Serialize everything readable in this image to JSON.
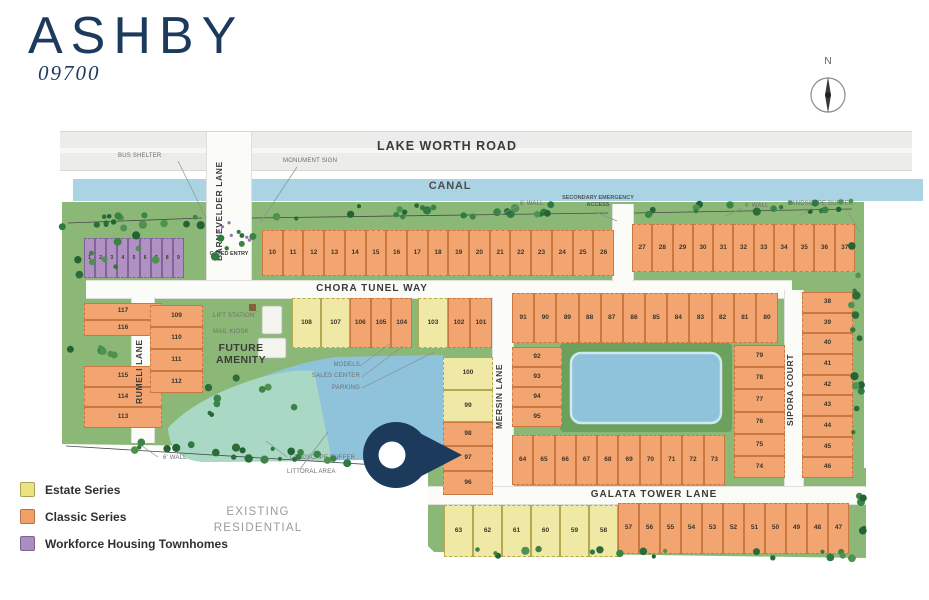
{
  "title": "ASHBY",
  "community_number": "09700",
  "compass": {
    "north_label": "N"
  },
  "streets": {
    "lake_worth_road": "LAKE WORTH ROAD",
    "canal": "CANAL",
    "barnevelder_lane": "BARNEVELDER LANE",
    "chora_tunel_way": "CHORA TUNEL WAY",
    "rumeli_lane": "RUMELI LANE",
    "mersin_lane": "MERSIN LANE",
    "sipora_court": "SIPORA COURT",
    "galata_tower_lane": "GALATA TOWER LANE"
  },
  "map_labels": {
    "bus_shelter": "BUS SHELTER",
    "monument_sign": "MONUMENT SIGN",
    "gated_entry": "GATED ENTRY",
    "secondary_emergency_access": "SECONDARY EMERGENCY ACCESS",
    "wall_6ft": "6' WALL",
    "landscape_buffer": "LANDSCAPE BUFFER",
    "littoral_area": "LITTORAL AREA",
    "lift_station": "LIFT STATION",
    "mail_kiosk": "MAIL KIOSK",
    "future_amenity": "FUTURE AMENITY",
    "models": "MODELS",
    "sales_center": "SALES CENTER",
    "parking": "PARKING",
    "existing_residential": "EXISTING RESIDENTIAL"
  },
  "legend": [
    {
      "label": "Estate Series",
      "series": "estate",
      "color": "#ECE27E"
    },
    {
      "label": "Classic Series",
      "series": "classic",
      "color": "#F2A066"
    },
    {
      "label": "Workforce Housing Townhomes",
      "series": "workforce",
      "color": "#AC8DC2"
    }
  ],
  "colors": {
    "estate": "#EFE9A5",
    "classic": "#F3A571",
    "workforce": "#B191C4",
    "water_blue": "#8FC3DC",
    "water_littoral": "#A9D8C4",
    "canal": "#AAD4E4",
    "ground_green": "#8CB877",
    "road_gray": "#ECECEA",
    "road_white": "#FBFBF8",
    "pin_navy": "#1B3A5C",
    "title_navy": "#1C3A5E"
  },
  "lot_groups": [
    {
      "id": "townhomes",
      "series": "workforce",
      "lots": [
        "1",
        "2",
        "3",
        "4",
        "5",
        "6",
        "7",
        "8",
        "9"
      ]
    },
    {
      "id": "top-row-west",
      "series": "classic",
      "lots": [
        "10",
        "11",
        "12",
        "13",
        "14",
        "15",
        "16",
        "17",
        "18",
        "19",
        "20",
        "21",
        "22",
        "23",
        "24",
        "25",
        "26"
      ]
    },
    {
      "id": "top-row-east",
      "series": "classic",
      "lots": [
        "27",
        "28",
        "29",
        "30",
        "31",
        "32",
        "33",
        "34",
        "35",
        "36",
        "37"
      ]
    },
    {
      "id": "west-a",
      "series": "classic",
      "lots": [
        "117",
        "116"
      ]
    },
    {
      "id": "west-b",
      "series": "classic",
      "lots": [
        "115",
        "114",
        "113"
      ]
    },
    {
      "id": "rumeli-east",
      "series": "classic",
      "lots": [
        "109",
        "110",
        "111",
        "112"
      ]
    },
    {
      "id": "chora-south-estate",
      "series": "estate",
      "lots": [
        "108",
        "107"
      ]
    },
    {
      "id": "chora-south-classic",
      "series": "classic",
      "lots": [
        "106",
        "105",
        "104"
      ]
    },
    {
      "id": "chora-south-estate-2",
      "series": "estate",
      "lots": [
        "103"
      ]
    },
    {
      "id": "chora-south-classic-2",
      "series": "classic",
      "lots": [
        "102",
        "101"
      ]
    },
    {
      "id": "mersin-west-estate",
      "series": "estate",
      "lots": [
        "100",
        "99"
      ]
    },
    {
      "id": "mersin-west-classic",
      "series": "classic",
      "lots": [
        "98",
        "97",
        "96"
      ]
    },
    {
      "id": "center-north",
      "series": "classic",
      "lots": [
        "91",
        "90",
        "89",
        "88",
        "87",
        "86",
        "85",
        "84",
        "83",
        "82",
        "81",
        "80"
      ]
    },
    {
      "id": "center-west",
      "series": "classic",
      "lots": [
        "92",
        "93",
        "94",
        "95"
      ]
    },
    {
      "id": "center-east",
      "series": "classic",
      "lots": [
        "79",
        "78",
        "77",
        "76",
        "75",
        "74"
      ]
    },
    {
      "id": "center-south",
      "series": "classic",
      "lots": [
        "64",
        "65",
        "66",
        "67",
        "68",
        "69",
        "70",
        "71",
        "72",
        "73"
      ]
    },
    {
      "id": "east-column",
      "series": "classic",
      "lots": [
        "38",
        "39",
        "40",
        "41",
        "42",
        "43",
        "44",
        "45",
        "46"
      ]
    },
    {
      "id": "galata-south-estate",
      "series": "estate",
      "lots": [
        "63",
        "62",
        "61",
        "60",
        "59",
        "58"
      ]
    },
    {
      "id": "galata-south-classic",
      "series": "classic",
      "lots": [
        "57",
        "56",
        "55",
        "54",
        "53",
        "52",
        "51",
        "50",
        "49",
        "48",
        "47"
      ]
    }
  ]
}
